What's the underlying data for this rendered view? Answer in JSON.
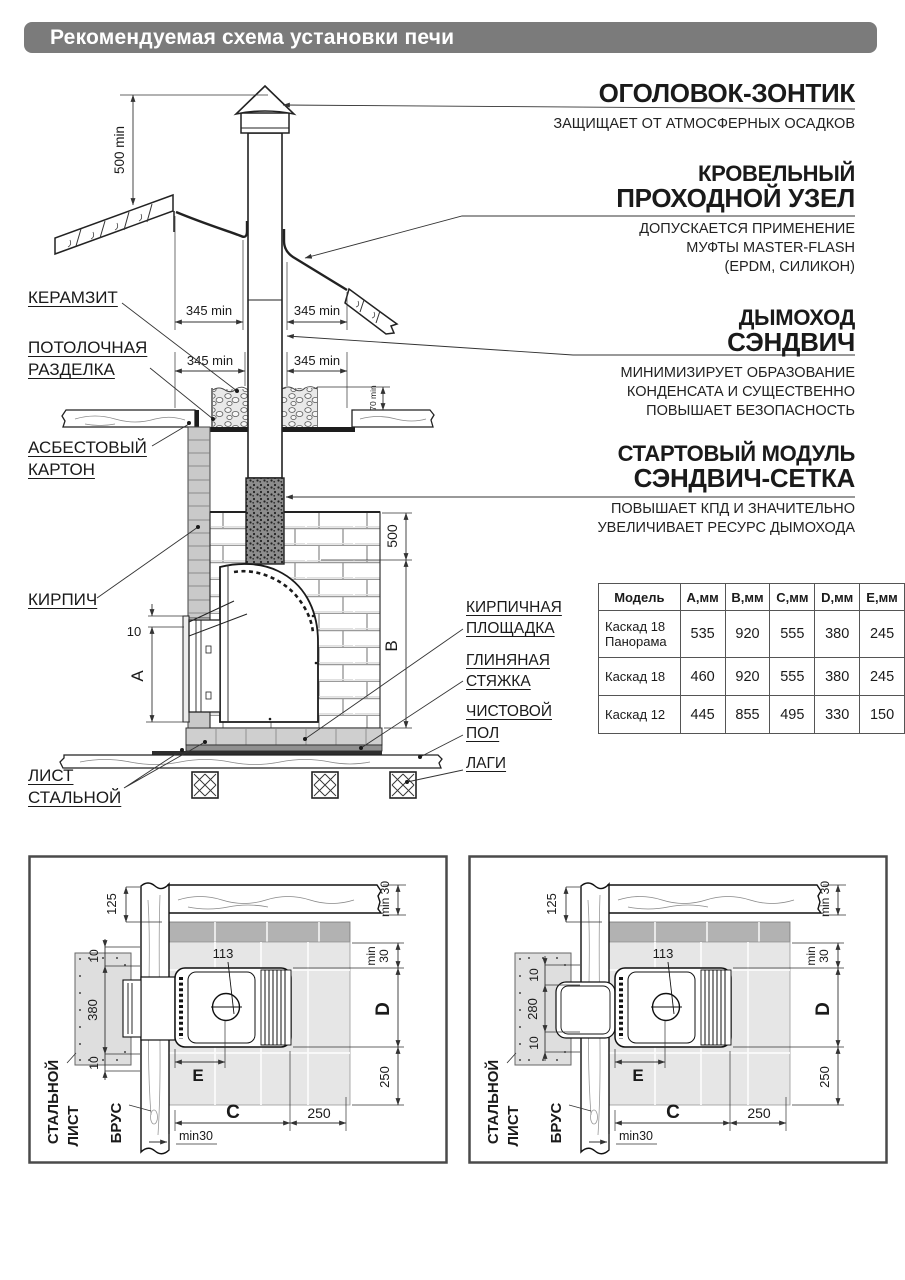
{
  "header": {
    "title": "Рекомендуемая схема установки печи"
  },
  "annotations": {
    "right": [
      {
        "title1": "",
        "title2": "ОГОЛОВОК-ЗОНТИК",
        "desc": [
          "ЗАЩИЩАЕТ ОТ АТМОСФЕРНЫХ ОСАДКОВ"
        ]
      },
      {
        "title1": "КРОВЕЛЬНЫЙ",
        "title2": "ПРОХОДНОЙ УЗЕЛ",
        "desc": [
          "ДОПУСКАЕТСЯ ПРИМЕНЕНИЕ",
          "МУФТЫ MASTER-FLASH",
          "(EPDM, СИЛИКОН)"
        ]
      },
      {
        "title1": "ДЫМОХОД",
        "title2": "СЭНДВИЧ",
        "desc": [
          "МИНИМИЗИРУЕТ ОБРАЗОВАНИЕ",
          "КОНДЕНСАТА И СУЩЕСТВЕННО",
          "ПОВЫШАЕТ БЕЗОПАСНОСТЬ"
        ]
      },
      {
        "title1": "СТАРТОВЫЙ МОДУЛЬ",
        "title2": "СЭНДВИЧ-СЕТКА",
        "desc": [
          "ПОВЫШАЕТ  КПД  И  ЗНАЧИТЕЛЬНО",
          "УВЕЛИЧИВАЕТ РЕСУРС ДЫМОХОДА"
        ]
      }
    ]
  },
  "labels_left": {
    "keramzit": "КЕРАМЗИТ",
    "ceiling1": "ПОТОЛОЧНАЯ",
    "ceiling2": "РАЗДЕЛКА",
    "asbest1": "АСБЕСТОВЫЙ",
    "asbest2": "КАРТОН",
    "brick": "КИРПИЧ",
    "sheet1": "ЛИСТ",
    "sheet2": "СТАЛЬНОЙ"
  },
  "labels_mid": {
    "platform1": "КИРПИЧНАЯ",
    "platform2": "ПЛОЩАДКА",
    "clay1": "ГЛИНЯНАЯ",
    "clay2": "СТЯЖКА",
    "floor1": "ЧИСТОВОЙ",
    "floor2": "ПОЛ",
    "joists": "ЛАГИ"
  },
  "main_dims": {
    "d500min": "500 min",
    "d345min": "345 min",
    "d70min": "70 min",
    "d10": "10",
    "dA": "A",
    "d500": "500",
    "dB": "B"
  },
  "table": {
    "headers": [
      "Модель",
      "А,мм",
      "В,мм",
      "С,мм",
      "D,мм",
      "Е,мм"
    ],
    "rows": [
      {
        "model": "Каскад 18 Панорама",
        "values": [
          "535",
          "920",
          "555",
          "380",
          "245"
        ]
      },
      {
        "model": "Каскад 18",
        "values": [
          "460",
          "920",
          "555",
          "380",
          "245"
        ]
      },
      {
        "model": "Каскад 12",
        "values": [
          "445",
          "855",
          "495",
          "330",
          "150"
        ]
      }
    ]
  },
  "detail_left": {
    "dims": {
      "d125": "125",
      "dmin30_top": "min 30",
      "d10_top": "10",
      "d_depth": "380",
      "d10_bot": "10",
      "dmin": "min",
      "d30": "30",
      "dD": "D",
      "d250_side": "250",
      "d113": "113",
      "dE": "E",
      "dC": "C",
      "d250_bottom": "250",
      "dmin30_bottom": "min30"
    },
    "labels": {
      "sheet_line1": "СТАЛЬНОЙ",
      "sheet_line2": "ЛИСТ",
      "beam": "БРУС"
    }
  },
  "detail_right": {
    "dims": {
      "d125": "125",
      "dmin30_top": "min 30",
      "d10_top": "10",
      "d_depth": "280",
      "d10_bot": "10",
      "dmin": "min",
      "d30": "30",
      "dD": "D",
      "d250_side": "250",
      "d113": "113",
      "dE": "E",
      "dC": "C",
      "d250_bottom": "250",
      "dmin30_bottom": "min30"
    },
    "labels": {
      "sheet_line1": "СТАЛЬНОЙ",
      "sheet_line2": "ЛИСТ",
      "beam": "БРУС"
    }
  }
}
